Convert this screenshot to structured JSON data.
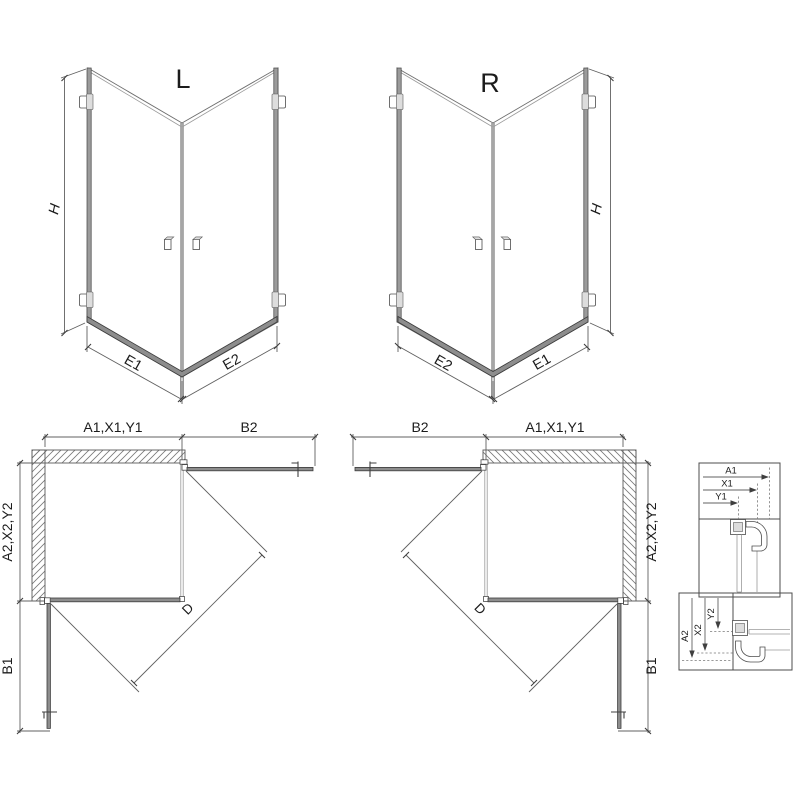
{
  "document": {
    "kind": "technical-drawing",
    "subject": "corner shower enclosure with two hinged doors, left (L) and right (R) versions"
  },
  "views": {
    "perspective_left": {
      "variant": "L",
      "height": "H",
      "left_side": "E1",
      "right_side": "E2"
    },
    "perspective_right": {
      "variant": "R",
      "height": "H",
      "left_side": "E2",
      "right_side": "E1"
    },
    "plan_left": {
      "width_top": "A1,X1,Y1",
      "door_open": "B2",
      "depth": "A2,X2,Y2",
      "door_open_side": "B1",
      "diagonal": "D"
    },
    "plan_right": {
      "width_top": "A1,X1,Y1",
      "door_open": "B2",
      "depth": "A2,X2,Y2",
      "door_open_side": "B1",
      "diagonal": "D"
    },
    "detail_horizontal": {
      "dim1": "A1",
      "dim2": "X1",
      "dim3": "Y1"
    },
    "detail_vertical": {
      "dim1": "A2",
      "dim2": "X2",
      "dim3": "Y2"
    }
  },
  "colors": {
    "background": "#ffffff",
    "outline": "#4c4c4c",
    "dimension_line": "#606060",
    "profile_fill": "#9b9b9b",
    "hatch": "#787878",
    "text": "#1c1c1c"
  }
}
